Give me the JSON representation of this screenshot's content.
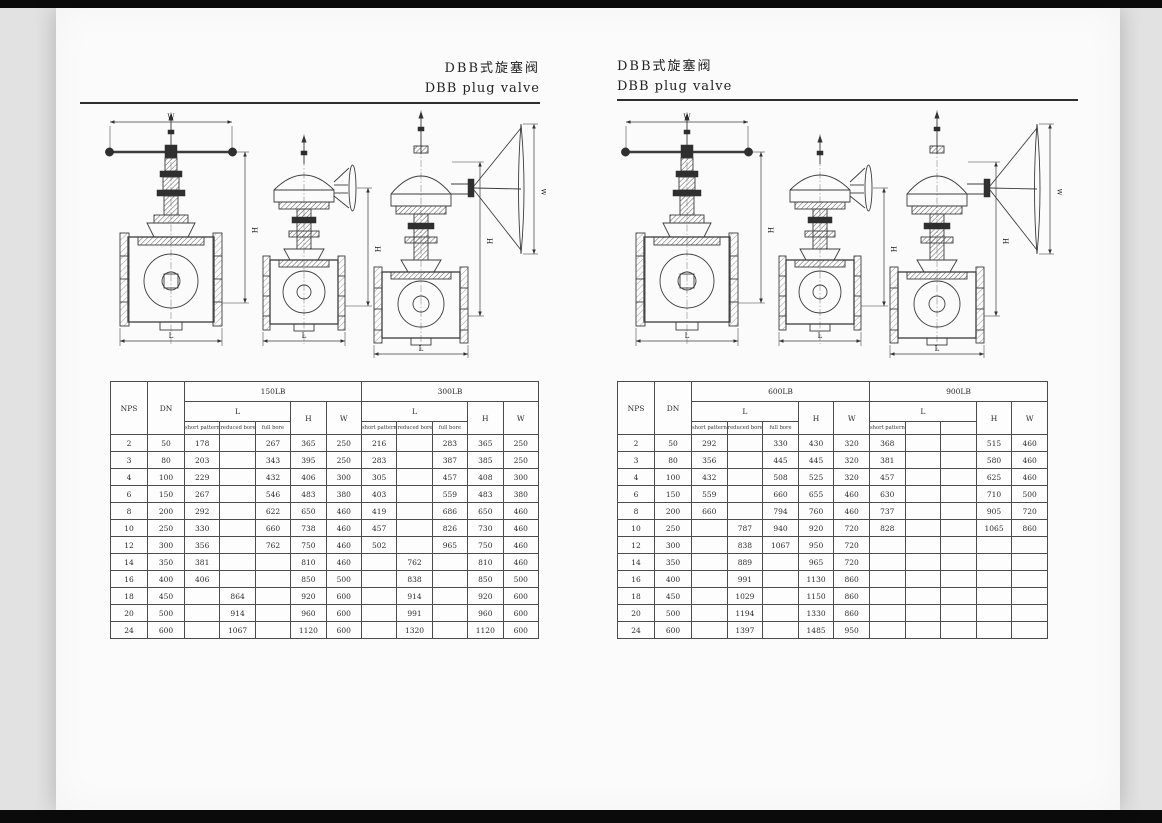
{
  "pages": {
    "left": {
      "title_cn": "DBB式旋塞阀",
      "title_en": "DBB plug valve"
    },
    "right": {
      "title_cn": "DBB式旋塞阀",
      "title_en": "DBB plug valve"
    }
  },
  "table_headers": {
    "nps": "NPS",
    "dn": "DN",
    "l": "L",
    "h": "H",
    "w": "W"
  },
  "tables": {
    "left": {
      "class_a": "150LB",
      "class_b": "300LB",
      "sub_a": [
        "short pattern",
        "reduced bore",
        "full bore"
      ],
      "sub_b": [
        "short pattern",
        "reduced bore",
        "full bore"
      ],
      "rows": [
        [
          "2",
          "50",
          "178",
          "",
          "267",
          "365",
          "250",
          "216",
          "",
          "283",
          "365",
          "250"
        ],
        [
          "3",
          "80",
          "203",
          "",
          "343",
          "395",
          "250",
          "283",
          "",
          "387",
          "385",
          "250"
        ],
        [
          "4",
          "100",
          "229",
          "",
          "432",
          "406",
          "300",
          "305",
          "",
          "457",
          "408",
          "300"
        ],
        [
          "6",
          "150",
          "267",
          "",
          "546",
          "483",
          "380",
          "403",
          "",
          "559",
          "483",
          "380"
        ],
        [
          "8",
          "200",
          "292",
          "",
          "622",
          "650",
          "460",
          "419",
          "",
          "686",
          "650",
          "460"
        ],
        [
          "10",
          "250",
          "330",
          "",
          "660",
          "738",
          "460",
          "457",
          "",
          "826",
          "730",
          "460"
        ],
        [
          "12",
          "300",
          "356",
          "",
          "762",
          "750",
          "460",
          "502",
          "",
          "965",
          "750",
          "460"
        ],
        [
          "14",
          "350",
          "381",
          "",
          "",
          "810",
          "460",
          "",
          "762",
          "",
          "810",
          "460"
        ],
        [
          "16",
          "400",
          "406",
          "",
          "",
          "850",
          "500",
          "",
          "838",
          "",
          "850",
          "500"
        ],
        [
          "18",
          "450",
          "",
          "864",
          "",
          "920",
          "600",
          "",
          "914",
          "",
          "920",
          "600"
        ],
        [
          "20",
          "500",
          "",
          "914",
          "",
          "960",
          "600",
          "",
          "991",
          "",
          "960",
          "600"
        ],
        [
          "24",
          "600",
          "",
          "1067",
          "",
          "1120",
          "600",
          "",
          "1320",
          "",
          "1120",
          "600"
        ]
      ]
    },
    "right": {
      "class_a": "600LB",
      "class_b": "900LB",
      "sub_a": [
        "short pattern",
        "reduced bore",
        "full bore"
      ],
      "sub_b": [
        "short pattern",
        "",
        ""
      ],
      "rows": [
        [
          "2",
          "50",
          "292",
          "",
          "330",
          "430",
          "320",
          "368",
          "",
          "",
          "515",
          "460"
        ],
        [
          "3",
          "80",
          "356",
          "",
          "445",
          "445",
          "320",
          "381",
          "",
          "",
          "580",
          "460"
        ],
        [
          "4",
          "100",
          "432",
          "",
          "508",
          "525",
          "320",
          "457",
          "",
          "",
          "625",
          "460"
        ],
        [
          "6",
          "150",
          "559",
          "",
          "660",
          "655",
          "460",
          "630",
          "",
          "",
          "710",
          "500"
        ],
        [
          "8",
          "200",
          "660",
          "",
          "794",
          "760",
          "460",
          "737",
          "",
          "",
          "905",
          "720"
        ],
        [
          "10",
          "250",
          "",
          "787",
          "940",
          "920",
          "720",
          "828",
          "",
          "",
          "1065",
          "860"
        ],
        [
          "12",
          "300",
          "",
          "838",
          "1067",
          "950",
          "720",
          "",
          "",
          "",
          "",
          ""
        ],
        [
          "14",
          "350",
          "",
          "889",
          "",
          "965",
          "720",
          "",
          "",
          "",
          "",
          ""
        ],
        [
          "16",
          "400",
          "",
          "991",
          "",
          "1130",
          "860",
          "",
          "",
          "",
          "",
          ""
        ],
        [
          "18",
          "450",
          "",
          "1029",
          "",
          "1150",
          "860",
          "",
          "",
          "",
          "",
          ""
        ],
        [
          "20",
          "500",
          "",
          "1194",
          "",
          "1330",
          "860",
          "",
          "",
          "",
          "",
          ""
        ],
        [
          "24",
          "600",
          "",
          "1397",
          "",
          "1485",
          "950",
          "",
          "",
          "",
          "",
          ""
        ]
      ]
    }
  },
  "drawing_labels": {
    "w": "W",
    "h": "H",
    "l": "L"
  }
}
